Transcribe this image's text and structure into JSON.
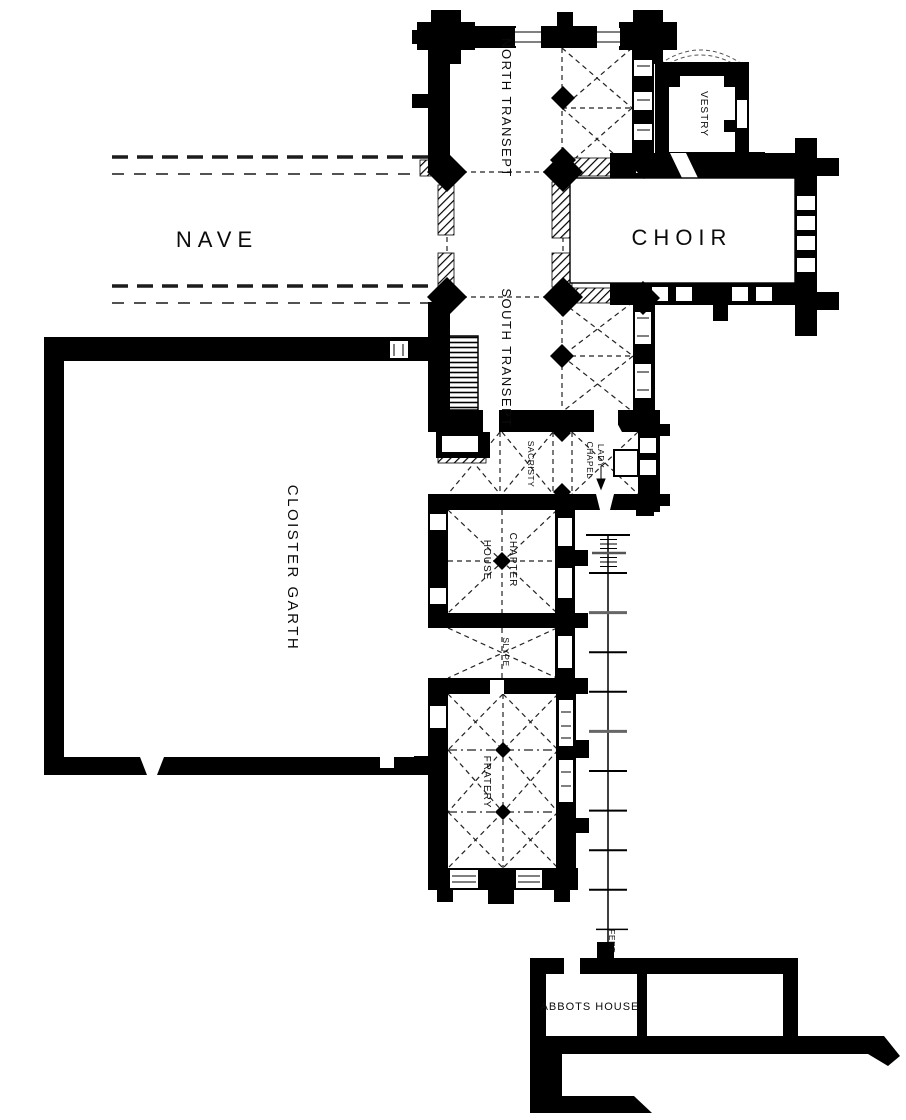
{
  "plan": {
    "title_hidden": "",
    "labels": {
      "nave": "NAVE",
      "choir": "CHOIR",
      "north_transept": "NORTH TRANSEPT",
      "south_transept": "SOUTH TRANSEPT",
      "vestry": "VESTRY",
      "cloister_garth": "CLOISTER  GARTH",
      "sacristy": "SACRISTY",
      "lady": "LADY",
      "chapel": "CHAPEL",
      "chapter": "CHAPTER",
      "house": "HOUSE",
      "slype": "SLYPE",
      "fratery": "FRATERY",
      "abbots_house": "ABBOTS HOUSE",
      "scale_unit": "FEET"
    },
    "colors": {
      "ink": "#000000",
      "paper": "#ffffff"
    }
  }
}
